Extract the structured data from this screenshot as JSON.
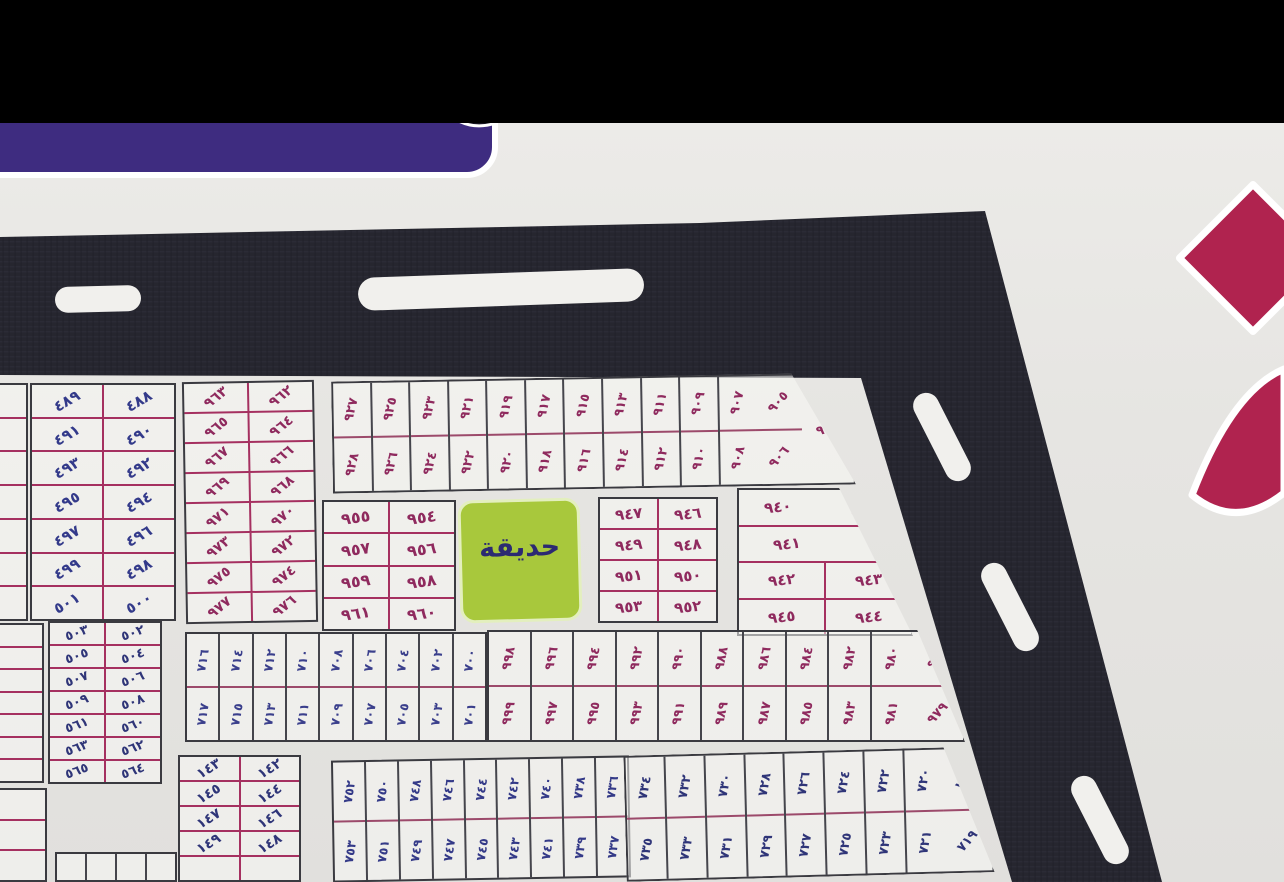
{
  "photo": {
    "background": "#e6e5e2",
    "top_bar_color": "#000000"
  },
  "frame_band": {
    "color": "#26262f",
    "slot_color": "#f1f0ed"
  },
  "sign_fragment": {
    "color": "#3e2c80",
    "outline": "#ffffff"
  },
  "big_numeral_fragment": {
    "color": "#b0234f",
    "outline": "#ffffff"
  },
  "garden": {
    "label": "حديقة",
    "bg": "#a8c83c",
    "ink": "#2c2a72"
  },
  "inks": {
    "magenta": "#8f2a5e",
    "navy": "#333a8a"
  },
  "blocks": [
    {
      "id": "block-489-501",
      "x": 30,
      "y": 260,
      "w": 146,
      "h": 238,
      "layout": "pairRows",
      "ink": "#333a8a",
      "line": "#a53060",
      "numRot": -30,
      "fs": 15,
      "rows": [
        {
          "cells": [
            {
              "t": "٤٨٩"
            },
            {
              "t": "٤٨٨"
            }
          ]
        },
        {
          "cells": [
            {
              "t": "٤٩١"
            },
            {
              "t": "٤٩٠"
            }
          ]
        },
        {
          "cells": [
            {
              "t": "٤٩٣"
            },
            {
              "t": "٤٩٢"
            }
          ]
        },
        {
          "cells": [
            {
              "t": "٤٩٥"
            },
            {
              "t": "٤٩٤"
            }
          ]
        },
        {
          "cells": [
            {
              "t": "٤٩٧"
            },
            {
              "t": "٤٩٦"
            }
          ]
        },
        {
          "cells": [
            {
              "t": "٤٩٩"
            },
            {
              "t": "٤٩٨"
            }
          ]
        },
        {
          "cells": [
            {
              "t": "٥٠١"
            },
            {
              "t": "٥٠٠"
            }
          ]
        }
      ]
    },
    {
      "id": "block-502-565",
      "x": 48,
      "y": 498,
      "w": 114,
      "h": 163,
      "layout": "pairRows",
      "ink": "#2f3578",
      "line": "#a53060",
      "numRot": -20,
      "fs": 13,
      "rows": [
        {
          "cells": [
            {
              "t": "٥٠٣"
            },
            {
              "t": "٥٠٢"
            }
          ]
        },
        {
          "cells": [
            {
              "t": "٥٠٥"
            },
            {
              "t": "٥٠٤"
            }
          ]
        },
        {
          "cells": [
            {
              "t": "٥٠٧"
            },
            {
              "t": "٥٠٦"
            }
          ]
        },
        {
          "cells": [
            {
              "t": "٥٠٩"
            },
            {
              "t": "٥٠٨"
            }
          ]
        },
        {
          "cells": [
            {
              "t": "٥٦١"
            },
            {
              "t": "٥٦٠"
            }
          ]
        },
        {
          "cells": [
            {
              "t": "٥٦٣"
            },
            {
              "t": "٥٦٢"
            }
          ]
        },
        {
          "cells": [
            {
              "t": "٥٦٥"
            },
            {
              "t": "٥٦٤"
            }
          ]
        }
      ]
    },
    {
      "id": "block-962-977",
      "x": 184,
      "y": 258,
      "w": 132,
      "h": 242,
      "layout": "pairRows",
      "ink": "#8f2a5e",
      "line": "#a53060",
      "numRot": -38,
      "fs": 14,
      "rot": -1,
      "rows": [
        {
          "cells": [
            {
              "t": "٩٦٣"
            },
            {
              "t": "٩٦٢"
            }
          ]
        },
        {
          "cells": [
            {
              "t": "٩٦٥"
            },
            {
              "t": "٩٦٤"
            }
          ]
        },
        {
          "cells": [
            {
              "t": "٩٦٧"
            },
            {
              "t": "٩٦٦"
            }
          ]
        },
        {
          "cells": [
            {
              "t": "٩٦٩"
            },
            {
              "t": "٩٦٨"
            }
          ]
        },
        {
          "cells": [
            {
              "t": "٩٧١"
            },
            {
              "t": "٩٧٠"
            }
          ]
        },
        {
          "cells": [
            {
              "t": "٩٧٣"
            },
            {
              "t": "٩٧٢"
            }
          ]
        },
        {
          "cells": [
            {
              "t": "٩٧٥"
            },
            {
              "t": "٩٧٤"
            }
          ]
        },
        {
          "cells": [
            {
              "t": "٩٧٧"
            },
            {
              "t": "٩٧٦"
            }
          ]
        }
      ]
    },
    {
      "id": "block-905-928-strip",
      "x": 332,
      "y": 254,
      "w": 523,
      "h": 112,
      "layout": "pairCols",
      "ink": "#8f2a5e",
      "line": "#9c4a6b",
      "numRot": -75,
      "fs": 13,
      "rot": -1,
      "clip": "polygon(0 0, 88% 0, 100% 100%, 0 100%)",
      "top": [
        "٩٢٧",
        "٩٢٥",
        "٩٢٣",
        "٩٢١",
        "٩١٩",
        "٩١٧",
        "٩١٥",
        "٩١٣",
        "٩١١",
        "٩٠٩",
        "٩٠٧"
      ],
      "bottom": [
        "٩٢٨",
        "٩٢٦",
        "٩٢٤",
        "٩٢٢",
        "٩٢٠",
        "٩١٨",
        "٩١٦",
        "٩١٤",
        "٩١٢",
        "٩١٠",
        "٩٠٨"
      ],
      "diag": {
        "top": "٩٠٥",
        "bottom": "٩٠٦"
      },
      "corner": {
        "t": "٩١٥"
      }
    },
    {
      "id": "block-954-961",
      "x": 322,
      "y": 377,
      "w": 134,
      "h": 131,
      "layout": "pairRows",
      "ink": "#8f2a5e",
      "line": "#a53060",
      "numRot": -8,
      "fs": 16,
      "rows": [
        {
          "cells": [
            {
              "t": "٩٥٥"
            },
            {
              "t": "٩٥٤"
            }
          ]
        },
        {
          "cells": [
            {
              "t": "٩٥٧"
            },
            {
              "t": "٩٥٦"
            }
          ]
        },
        {
          "cells": [
            {
              "t": "٩٥٩"
            },
            {
              "t": "٩٥٨"
            }
          ]
        },
        {
          "cells": [
            {
              "t": "٩٦١"
            },
            {
              "t": "٩٦٠"
            }
          ]
        }
      ]
    },
    {
      "id": "block-946-953",
      "x": 598,
      "y": 374,
      "w": 120,
      "h": 126,
      "layout": "pairRows",
      "ink": "#8f2a5e",
      "line": "#a53060",
      "numRot": -6,
      "fs": 15,
      "rows": [
        {
          "cells": [
            {
              "t": "٩٤٧"
            },
            {
              "t": "٩٤٦"
            }
          ]
        },
        {
          "cells": [
            {
              "t": "٩٤٩"
            },
            {
              "t": "٩٤٨"
            }
          ]
        },
        {
          "cells": [
            {
              "t": "٩٥١"
            },
            {
              "t": "٩٥٠"
            }
          ]
        },
        {
          "cells": [
            {
              "t": "٩٥٣"
            },
            {
              "t": "٩٥٢"
            }
          ]
        }
      ]
    },
    {
      "id": "block-939-945",
      "x": 737,
      "y": 365,
      "w": 176,
      "h": 148,
      "layout": "pairRows",
      "ink": "#8f2a5e",
      "line": "#a53060",
      "numRot": -6,
      "fs": 15,
      "clip": "polygon(0 0, 58% 0, 100% 100%, 0 100%)",
      "rows": [
        {
          "cells": [
            {
              "t": "٩٤٠",
              "f": 0.9
            },
            {
              "t": "٩٣٩",
              "r": -40,
              "noline": true,
              "f": 1.1
            }
          ]
        },
        {
          "cells": [
            {
              "t": "٩٤١",
              "f": 1
            },
            {
              "t": "",
              "noline": true,
              "f": 0.8
            }
          ]
        },
        {
          "cells": [
            {
              "t": "٩٤٢"
            },
            {
              "t": "٩٤٣"
            }
          ]
        },
        {
          "cells": [
            {
              "t": "٩٤٥"
            },
            {
              "t": "٩٤٤"
            }
          ]
        }
      ]
    },
    {
      "id": "block-700-717",
      "x": 185,
      "y": 509,
      "w": 302,
      "h": 110,
      "layout": "pairCols",
      "ink": "#3a3f8c",
      "line": "#9c4a6b",
      "numRot": -80,
      "fs": 12.5,
      "top": [
        "٧١٦",
        "٧١٤",
        "٧١٢",
        "٧١٠",
        "٧٠٨",
        "٧٠٦",
        "٧٠٤",
        "٧٠٢",
        "٧٠٠"
      ],
      "bottom": [
        "٧١٧",
        "٧١٥",
        "٧١٣",
        "٧١١",
        "٧٠٩",
        "٧٠٧",
        "٧٠٥",
        "٧٠٣",
        "٧٠١"
      ]
    },
    {
      "id": "block-978-999",
      "x": 487,
      "y": 507,
      "w": 478,
      "h": 112,
      "layout": "pairCols",
      "ink": "#8f2a5e",
      "line": "#9c4a6b",
      "numRot": -78,
      "fs": 13,
      "clip": "polygon(0 0, 90% 0, 100% 100%, 0 100%)",
      "top": [
        "٩٩٨",
        "٩٩٦",
        "٩٩٤",
        "٩٩٢",
        "٩٩٠",
        "٩٨٨",
        "٩٨٦",
        "٩٨٤",
        "٩٨٢",
        "٩٨٠"
      ],
      "bottom": [
        "٩٩٩",
        "٩٩٧",
        "٩٩٥",
        "٩٩٣",
        "٩٩١",
        "٩٨٩",
        "٩٨٧",
        "٩٨٥",
        "٩٨٣",
        "٩٨١"
      ],
      "diag": {
        "top": "٩٧٨",
        "bottom": "٩٧٩"
      }
    },
    {
      "id": "block-142-149",
      "x": 178,
      "y": 632,
      "w": 123,
      "h": 127,
      "layout": "pairRows",
      "ink": "#2f3578",
      "line": "#a53060",
      "numRot": -32,
      "fs": 14,
      "rows": [
        {
          "cells": [
            {
              "t": "١٤٣"
            },
            {
              "t": "١٤٢"
            }
          ]
        },
        {
          "cells": [
            {
              "t": "١٤٥"
            },
            {
              "t": "١٤٤"
            }
          ]
        },
        {
          "cells": [
            {
              "t": "١٤٧"
            },
            {
              "t": "١٤٦"
            }
          ]
        },
        {
          "cells": [
            {
              "t": "١٤٩"
            },
            {
              "t": "١٤٨"
            }
          ]
        },
        {
          "cells": [
            {
              "t": ""
            },
            {
              "t": ""
            }
          ]
        }
      ]
    },
    {
      "id": "block-736-753",
      "x": 332,
      "y": 635,
      "w": 298,
      "h": 122,
      "layout": "pairCols",
      "ink": "#343a88",
      "line": "#9c4a6b",
      "numRot": -80,
      "fs": 12.5,
      "rot": -1,
      "top": [
        "٧٥٢",
        "٧٥٠",
        "٧٤٨",
        "٧٤٦",
        "٧٤٤",
        "٧٤٢",
        "٧٤٠",
        "٧٣٨",
        "٧٣٦"
      ],
      "bottom": [
        "٧٥٣",
        "٧٥١",
        "٧٤٩",
        "٧٤٧",
        "٧٤٥",
        "٧٤٣",
        "٧٤١",
        "٧٣٩",
        "٧٣٧"
      ]
    },
    {
      "id": "block-718-735",
      "x": 625,
      "y": 628,
      "w": 368,
      "h": 126,
      "layout": "pairCols",
      "ink": "#2f3578",
      "line": "#9c4a6b",
      "numRot": -78,
      "fs": 13,
      "rot": -1.5,
      "clip": "polygon(0 0, 87% 0, 100% 100%, 0 100%)",
      "top": [
        "٧٣٤",
        "٧٣٢",
        "٧٣٠",
        "٧٢٨",
        "٧٢٦",
        "٧٢٤",
        "٧٢٢",
        "٧٢٠"
      ],
      "bottom": [
        "٧٣٥",
        "٧٣٣",
        "٧٣١",
        "٧٢٩",
        "٧٢٧",
        "٧٢٥",
        "٧٢٣",
        "٧٢١"
      ],
      "diag": {
        "top": "٧١٨",
        "bottom": "٧١٩"
      }
    },
    {
      "id": "edge-block-left-top",
      "x": -22,
      "y": 260,
      "w": 50,
      "h": 238,
      "layout": "pairRows",
      "ink": "#2f3578",
      "line": "#a53060",
      "numRot": -20,
      "fs": 12,
      "rows": [
        {
          "cells": [
            {
              "t": ""
            }
          ]
        },
        {
          "cells": [
            {
              "t": ""
            }
          ]
        },
        {
          "cells": [
            {
              "t": ""
            }
          ]
        },
        {
          "cells": [
            {
              "t": ""
            }
          ]
        },
        {
          "cells": [
            {
              "t": ""
            }
          ]
        },
        {
          "cells": [
            {
              "t": ""
            }
          ]
        },
        {
          "cells": [
            {
              "t": ""
            }
          ]
        }
      ]
    },
    {
      "id": "edge-block-left-mid",
      "x": -30,
      "y": 500,
      "w": 74,
      "h": 160,
      "layout": "pairRows",
      "ink": "#2f3578",
      "line": "#a53060",
      "numRot": -20,
      "fs": 12,
      "rows": [
        {
          "cells": [
            {
              "t": ""
            }
          ]
        },
        {
          "cells": [
            {
              "t": ""
            }
          ]
        },
        {
          "cells": [
            {
              "t": ""
            }
          ]
        },
        {
          "cells": [
            {
              "t": ""
            }
          ]
        },
        {
          "cells": [
            {
              "t": ""
            }
          ]
        },
        {
          "cells": [
            {
              "t": ""
            }
          ]
        },
        {
          "cells": [
            {
              "t": ""
            }
          ]
        }
      ]
    },
    {
      "id": "edge-block-left-bottom",
      "x": -25,
      "y": 665,
      "w": 72,
      "h": 94,
      "layout": "pairRows",
      "ink": "#2f3578",
      "line": "#a53060",
      "numRot": -20,
      "fs": 12,
      "rows": [
        {
          "cells": [
            {
              "t": ""
            }
          ]
        },
        {
          "cells": [
            {
              "t": ""
            }
          ]
        },
        {
          "cells": [
            {
              "t": ""
            }
          ]
        }
      ]
    },
    {
      "id": "edge-strip-bottom-left",
      "x": 55,
      "y": 729,
      "w": 122,
      "h": 30,
      "layout": "pairCols",
      "ink": "#2f3578",
      "line": "#9c4a6b",
      "numRot": -80,
      "fs": 11,
      "top": [
        "",
        "",
        "",
        ""
      ],
      "bottom": []
    }
  ]
}
